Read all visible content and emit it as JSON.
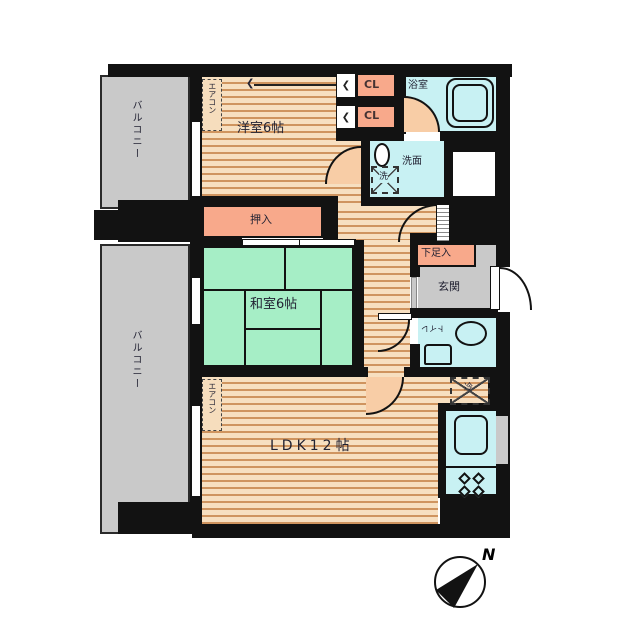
{
  "labels": {
    "yoshitsu": "洋室6帖",
    "washitsu": "和室6帖",
    "ldk": "LDK12帖",
    "oshiire": "押入",
    "cl_upper": "CL",
    "cl_lower": "CL",
    "bathroom": "浴室",
    "washroom": "洗面",
    "washer": "洗",
    "getabako": "下足入",
    "genkan": "玄関",
    "toilet": "トイレ",
    "fridge": "冷",
    "balcony_top": "バルコニー",
    "balcony_bottom": "バルコニー",
    "aircon_yoshitsu": "エアコン",
    "aircon_ldk": "エアコン",
    "north": "N"
  },
  "icons": {
    "chevron_left": "❮"
  },
  "colors": {
    "wall": "#121212",
    "wood_floor_base": "#f7dfc0",
    "wood_floor_stripe": "#cf945f",
    "tatami_green": "#a6eec6",
    "wet_area_cyan": "#c8f1f3",
    "closet_salmon": "#f8a98b",
    "balcony_gray": "#c9c9c9",
    "door_peach": "#f8cda6",
    "background": "#ffffff"
  }
}
